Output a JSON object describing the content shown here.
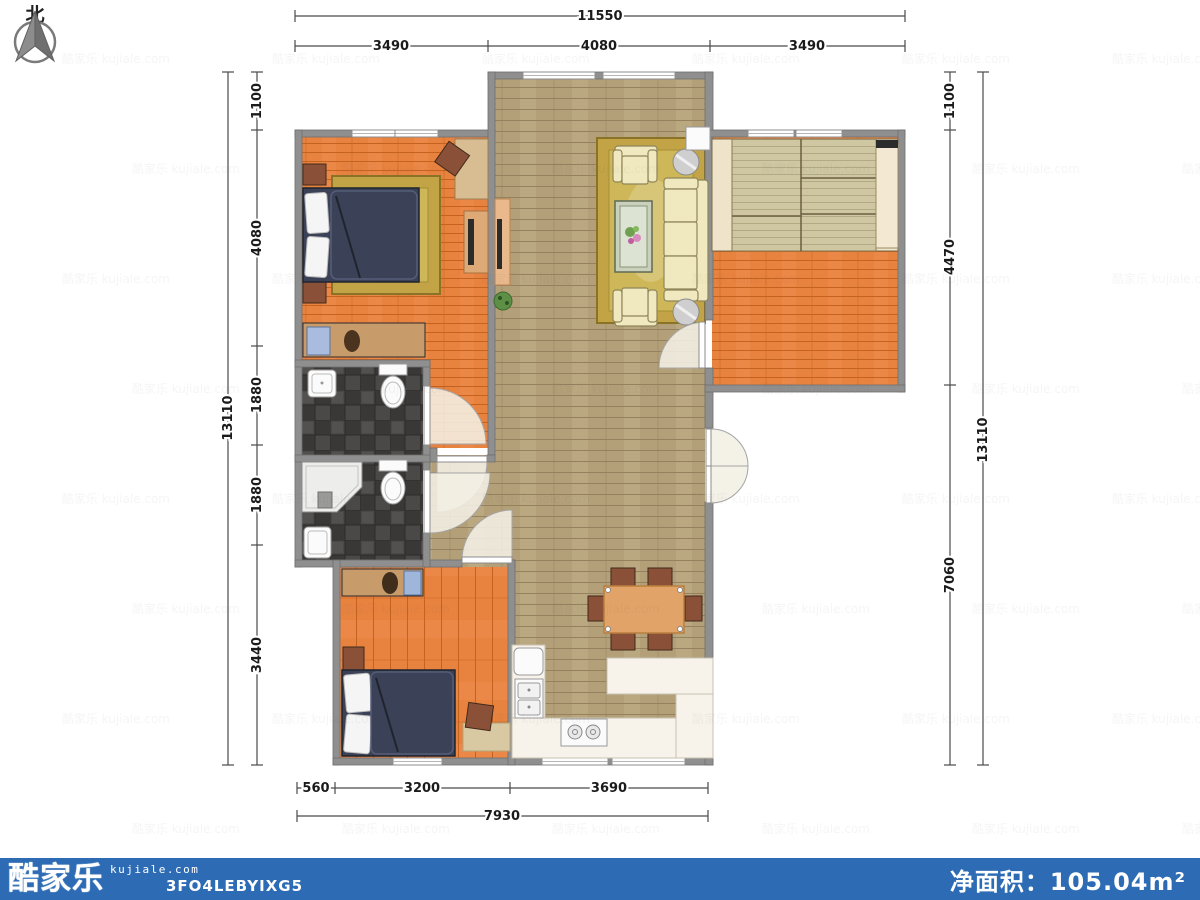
{
  "compass": {
    "label": "北"
  },
  "dims": {
    "top": {
      "total": "11550",
      "segments": [
        "3490",
        "4080",
        "3490"
      ]
    },
    "left": {
      "total": "13110",
      "segments": [
        "1100",
        "4080",
        "1880",
        "1880",
        "3440"
      ]
    },
    "right": {
      "total": "13110",
      "segments": [
        "1100",
        "4470",
        "7060"
      ]
    },
    "bottom": {
      "total": "7930",
      "segments": [
        "560",
        "3200",
        "3690"
      ]
    }
  },
  "footer": {
    "brand": "酷家乐",
    "domain": "kujiale.com",
    "code": "3FO4LEBYIXG5",
    "area": "净面积：105.04m²"
  },
  "watermark": {
    "text": "酷家乐 kujiale.com"
  },
  "colors": {
    "wall": "#8f8f8f",
    "wall_edge": "#6e6e6e",
    "floor_orange": "#e8823f",
    "floor_orange_line": "#c4621f",
    "floor_living": "#b3a078",
    "floor_living_line": "#96815f",
    "tile_dark": "#4b4947",
    "tile_alt": "#3a3836",
    "rug_gold": "#c2a345",
    "rug_inner": "#cdb759",
    "bed_navy": "#3b4156",
    "sofa": "#f0e9c0",
    "sofa_edge": "#8f855a",
    "counter": "#f7f3ea",
    "table_wood": "#e2a368",
    "chair_brown": "#8a5138",
    "tatami": "#cfc7a2",
    "tatami_frame": "#efe4c9",
    "footer": "#2d6cb5"
  }
}
